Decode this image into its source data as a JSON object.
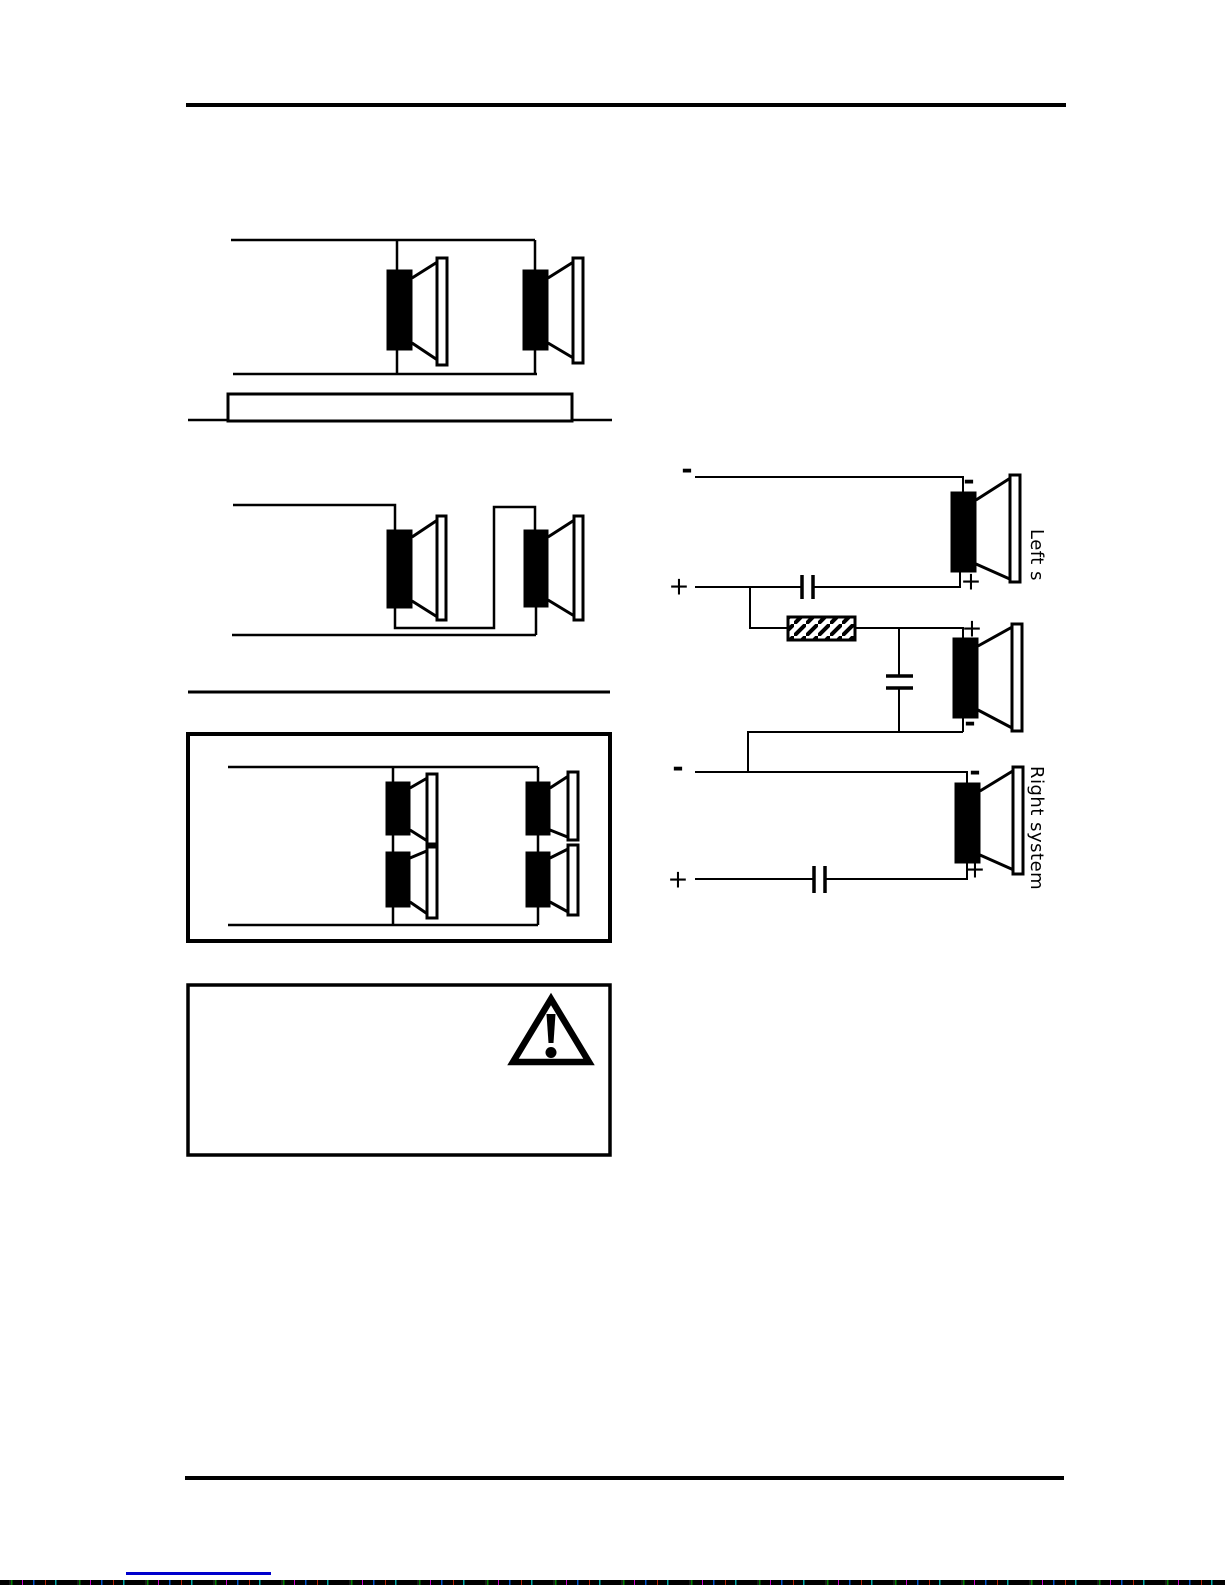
{
  "figures": {
    "crossover": {
      "left_system_label": "Left s",
      "right_system_label": "Right system",
      "plus": "+",
      "minus": "-"
    }
  },
  "colors": {
    "ink": "#000000",
    "link": "#0000cc"
  }
}
